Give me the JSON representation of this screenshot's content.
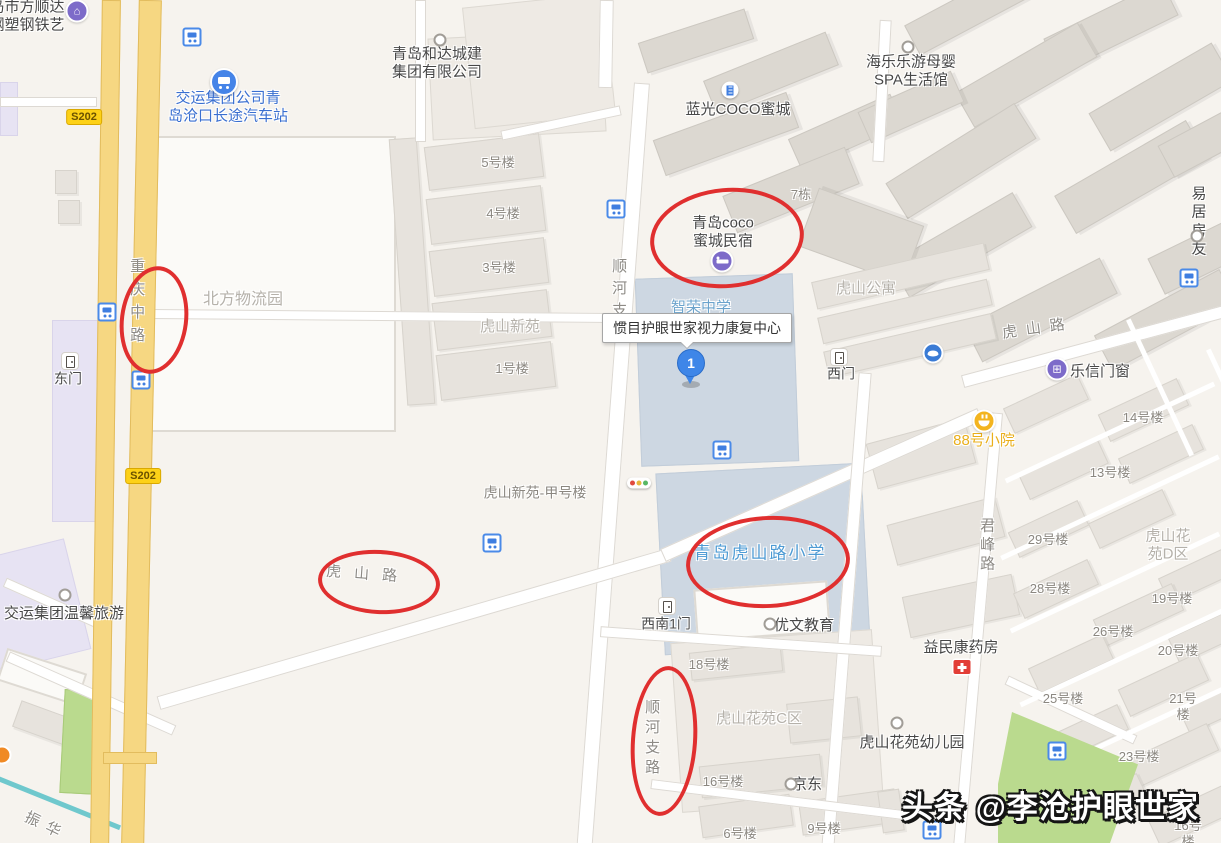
{
  "annotation_color": "#e02f2f",
  "tooltip": {
    "text": "惯目护眼世家视力康复中心"
  },
  "marker": {
    "number": "1"
  },
  "watermark": {
    "text": "头条 @李沧护眼世家"
  },
  "road_badges": [
    {
      "text": "S202",
      "x": 84,
      "y": 117
    },
    {
      "text": "S202",
      "x": 143,
      "y": 476
    }
  ],
  "labels": [
    {
      "name": "poi-fangshunda",
      "text": "岛市方顺达\n钢塑钢铁艺",
      "x": 27,
      "y": 17,
      "cls": "poi"
    },
    {
      "name": "poi-bus-terminal",
      "text": "交运集团公司青\n岛沧口长途汽车站",
      "x": 228,
      "y": 108,
      "cls": "poi-blue"
    },
    {
      "name": "poi-hedachengjian",
      "text": "青岛和达城建\n集团有限公司",
      "x": 437,
      "y": 64,
      "cls": "poi"
    },
    {
      "name": "poi-languang-coco",
      "text": "蓝光COCO蜜城",
      "x": 738,
      "y": 110,
      "cls": "poi"
    },
    {
      "name": "poi-haileyou",
      "text": "海乐乐游母婴\nSPA生活馆",
      "x": 911,
      "y": 72,
      "cls": "poi"
    },
    {
      "name": "poi-coco-homestay",
      "text": "青岛coco\n蜜城民宿",
      "x": 723,
      "y": 233,
      "cls": "poi"
    },
    {
      "name": "unit-7dong",
      "text": "7栋",
      "x": 801,
      "y": 195,
      "cls": "unit"
    },
    {
      "name": "area-hushan-apartment",
      "text": "虎山公寓",
      "x": 866,
      "y": 289,
      "cls": "area"
    },
    {
      "name": "gate-east",
      "text": "东门",
      "x": 68,
      "y": 379,
      "cls": "gate"
    },
    {
      "name": "unit-5haolou",
      "text": "5号楼",
      "x": 498,
      "y": 163,
      "cls": "unit"
    },
    {
      "name": "unit-4haolou",
      "text": "4号楼",
      "x": 503,
      "y": 214,
      "cls": "unit"
    },
    {
      "name": "unit-3haolou",
      "text": "3号楼",
      "x": 499,
      "y": 268,
      "cls": "unit"
    },
    {
      "name": "unit-1haolou",
      "text": "1号楼",
      "x": 512,
      "y": 369,
      "cls": "unit"
    },
    {
      "name": "area-hushanxinyuan",
      "text": "虎山新苑",
      "x": 510,
      "y": 327,
      "cls": "area"
    },
    {
      "name": "area-beifang-logistics",
      "text": "北方物流园",
      "x": 243,
      "y": 300,
      "cls": "area-lg"
    },
    {
      "name": "poi-zhirong-school",
      "text": "智荣中学",
      "x": 701,
      "y": 308,
      "cls": "school-blue"
    },
    {
      "name": "gate-west",
      "text": "西门",
      "x": 841,
      "y": 374,
      "cls": "gate"
    },
    {
      "name": "poi-lexin-windows",
      "text": "乐信门窗",
      "x": 1100,
      "y": 372,
      "cls": "poi"
    },
    {
      "name": "poi-88-courtyard",
      "text": "88号小院",
      "x": 984,
      "y": 441,
      "cls": "yellow-poi"
    },
    {
      "name": "unit-14haolou",
      "text": "14号楼",
      "x": 1143,
      "y": 418,
      "cls": "unit"
    },
    {
      "name": "unit-13haolou",
      "text": "13号楼",
      "x": 1110,
      "y": 473,
      "cls": "unit"
    },
    {
      "name": "unit-29haolou",
      "text": "29号楼",
      "x": 1048,
      "y": 540,
      "cls": "unit"
    },
    {
      "name": "unit-28haolou",
      "text": "28号楼",
      "x": 1050,
      "y": 589,
      "cls": "unit"
    },
    {
      "name": "unit-19haolou",
      "text": "19号楼",
      "x": 1172,
      "y": 599,
      "cls": "unit"
    },
    {
      "name": "unit-26haolou",
      "text": "26号楼",
      "x": 1113,
      "y": 632,
      "cls": "unit"
    },
    {
      "name": "unit-20haolou",
      "text": "20号楼",
      "x": 1178,
      "y": 651,
      "cls": "unit"
    },
    {
      "name": "unit-25haolou",
      "text": "25号楼",
      "x": 1063,
      "y": 699,
      "cls": "unit"
    },
    {
      "name": "unit-21haolou",
      "text": "21号楼",
      "x": 1183,
      "y": 707,
      "cls": "unit"
    },
    {
      "name": "unit-23haolou",
      "text": "23号楼",
      "x": 1139,
      "y": 757,
      "cls": "unit"
    },
    {
      "name": "unit-16haolou-right",
      "text": "16号楼",
      "x": 1188,
      "y": 834,
      "cls": "unit"
    },
    {
      "name": "area-hushan-d",
      "text": "虎山花苑D区",
      "x": 1168,
      "y": 546,
      "cls": "area"
    },
    {
      "name": "unit-jiahaolou",
      "text": "虎山新苑-甲号楼",
      "x": 535,
      "y": 493,
      "cls": "unit-md"
    },
    {
      "name": "poi-hushan-primary",
      "text": "青岛虎山路小学",
      "x": 760,
      "y": 554,
      "cls": "school-lg"
    },
    {
      "name": "gate-southwest1",
      "text": "西南1门",
      "x": 666,
      "y": 624,
      "cls": "gate"
    },
    {
      "name": "poi-youwen-edu",
      "text": "优文教育",
      "x": 804,
      "y": 626,
      "cls": "poi"
    },
    {
      "name": "poi-yimin-pharmacy",
      "text": "益民康药房",
      "x": 961,
      "y": 648,
      "cls": "poi"
    },
    {
      "name": "unit-18haolou",
      "text": "18号楼",
      "x": 709,
      "y": 665,
      "cls": "unit"
    },
    {
      "name": "area-hushan-c",
      "text": "虎山花苑C区",
      "x": 759,
      "y": 719,
      "cls": "area"
    },
    {
      "name": "poi-kindergarten",
      "text": "虎山花苑幼儿园",
      "x": 912,
      "y": 743,
      "cls": "poi"
    },
    {
      "name": "unit-16haolou-left",
      "text": "16号楼",
      "x": 723,
      "y": 782,
      "cls": "unit"
    },
    {
      "name": "poi-jingdong",
      "text": "京东",
      "x": 807,
      "y": 785,
      "cls": "poi"
    },
    {
      "name": "unit-6haolou",
      "text": "6号楼",
      "x": 740,
      "y": 834,
      "cls": "unit"
    },
    {
      "name": "unit-9haolou",
      "text": "9号楼",
      "x": 824,
      "y": 829,
      "cls": "unit"
    },
    {
      "name": "poi-jiaoyun-travel",
      "text": "交运集团温馨旅游",
      "x": 64,
      "y": 614,
      "cls": "poi"
    },
    {
      "name": "poi-yiju-fangyou",
      "text": "易居房友",
      "x": 1199,
      "y": 222,
      "cls": "poi"
    },
    {
      "name": "road-chongqing-middle",
      "text": "重庆中路",
      "x": 136,
      "y": 304,
      "cls": "road-name",
      "vertical": true,
      "ls": 8
    },
    {
      "name": "road-shunhe-top",
      "text": "顺河支",
      "x": 618,
      "y": 291,
      "cls": "road-name",
      "vertical": true,
      "ls": 7
    },
    {
      "name": "road-shunhe-bottom",
      "text": "顺河支路",
      "x": 651,
      "y": 739,
      "cls": "road-name",
      "vertical": true,
      "ls": 5
    },
    {
      "name": "road-junfeng",
      "text": "君峰路",
      "x": 986,
      "y": 546,
      "cls": "road-name",
      "vertical": true,
      "ls": 4
    },
    {
      "name": "road-hushan-topright",
      "text": "虎山路",
      "x": 1038,
      "y": 329,
      "cls": "road-name",
      "rotate": -8,
      "ls": 9
    },
    {
      "name": "road-hushan-middle",
      "text": "虎山路",
      "x": 368,
      "y": 575,
      "cls": "road-name",
      "rotate": 4,
      "ls": 13
    },
    {
      "name": "road-zhenhua",
      "text": "振华",
      "x": 46,
      "y": 827,
      "cls": "road-name",
      "rotate": 26,
      "ls": 8
    }
  ],
  "icons": [
    {
      "name": "shop-icon",
      "type": "purple-circle",
      "x": 77,
      "y": 11,
      "glyph": "⌂"
    },
    {
      "name": "bus-terminal-icon",
      "type": "bus-circle",
      "x": 224,
      "y": 82
    },
    {
      "name": "bus-stop-icon",
      "type": "bus-stop",
      "x": 192,
      "y": 37
    },
    {
      "name": "bus-stop-icon",
      "type": "bus-stop",
      "x": 107,
      "y": 312
    },
    {
      "name": "bus-stop-icon",
      "type": "bus-stop",
      "x": 141,
      "y": 380
    },
    {
      "name": "bus-stop-icon",
      "type": "bus-stop",
      "x": 616,
      "y": 209
    },
    {
      "name": "bus-stop-icon",
      "type": "bus-stop",
      "x": 722,
      "y": 450
    },
    {
      "name": "bus-stop-icon",
      "type": "bus-stop",
      "x": 492,
      "y": 543
    },
    {
      "name": "bus-stop-icon",
      "type": "bus-stop",
      "x": 1057,
      "y": 751
    },
    {
      "name": "bus-stop-icon",
      "type": "bus-stop",
      "x": 932,
      "y": 830
    },
    {
      "name": "bus-stop-icon",
      "type": "bus-stop",
      "x": 1189,
      "y": 278
    },
    {
      "name": "poi-dot-icon",
      "type": "poi-dot",
      "x": 440,
      "y": 40
    },
    {
      "name": "poi-dot-icon",
      "type": "poi-dot",
      "x": 908,
      "y": 47
    },
    {
      "name": "poi-dot-icon",
      "type": "poi-dot",
      "x": 65,
      "y": 595
    },
    {
      "name": "poi-dot-icon",
      "type": "poi-dot",
      "x": 770,
      "y": 624
    },
    {
      "name": "poi-dot-icon",
      "type": "poi-dot",
      "x": 791,
      "y": 784
    },
    {
      "name": "poi-dot-icon",
      "type": "poi-dot",
      "x": 897,
      "y": 723
    },
    {
      "name": "poi-dot-icon",
      "type": "poi-dot",
      "x": 1197,
      "y": 236
    },
    {
      "name": "hotel-bed-icon",
      "type": "bed",
      "x": 722,
      "y": 261
    },
    {
      "name": "building-icon",
      "type": "bldg-blue",
      "x": 730,
      "y": 90
    },
    {
      "name": "gate-door-icon",
      "type": "door",
      "x": 70,
      "y": 361
    },
    {
      "name": "gate-door-icon",
      "type": "door",
      "x": 839,
      "y": 357
    },
    {
      "name": "gate-door-icon",
      "type": "door",
      "x": 667,
      "y": 606
    },
    {
      "name": "china-mobile-icon",
      "type": "mobile",
      "x": 933,
      "y": 353
    },
    {
      "name": "window-shop-icon",
      "type": "purple-circle",
      "x": 1057,
      "y": 369,
      "glyph": "⊞"
    },
    {
      "name": "restaurant-icon",
      "type": "bowl",
      "x": 984,
      "y": 421
    },
    {
      "name": "pharmacy-icon",
      "type": "medical",
      "x": 962,
      "y": 667
    },
    {
      "name": "traffic-light-icon",
      "type": "traffic",
      "x": 639,
      "y": 483
    },
    {
      "name": "poi-orange-icon",
      "type": "orange-dot",
      "x": 2,
      "y": 755
    }
  ],
  "ellipses": [
    {
      "x": 650,
      "y": 188,
      "w": 146,
      "h": 92,
      "rotate": -5
    },
    {
      "x": 120,
      "y": 266,
      "w": 60,
      "h": 100,
      "rotate": 7
    },
    {
      "x": 318,
      "y": 550,
      "w": 114,
      "h": 56,
      "rotate": 3
    },
    {
      "x": 686,
      "y": 516,
      "w": 156,
      "h": 84,
      "rotate": -3
    },
    {
      "x": 631,
      "y": 666,
      "w": 58,
      "h": 142,
      "rotate": 4
    }
  ]
}
